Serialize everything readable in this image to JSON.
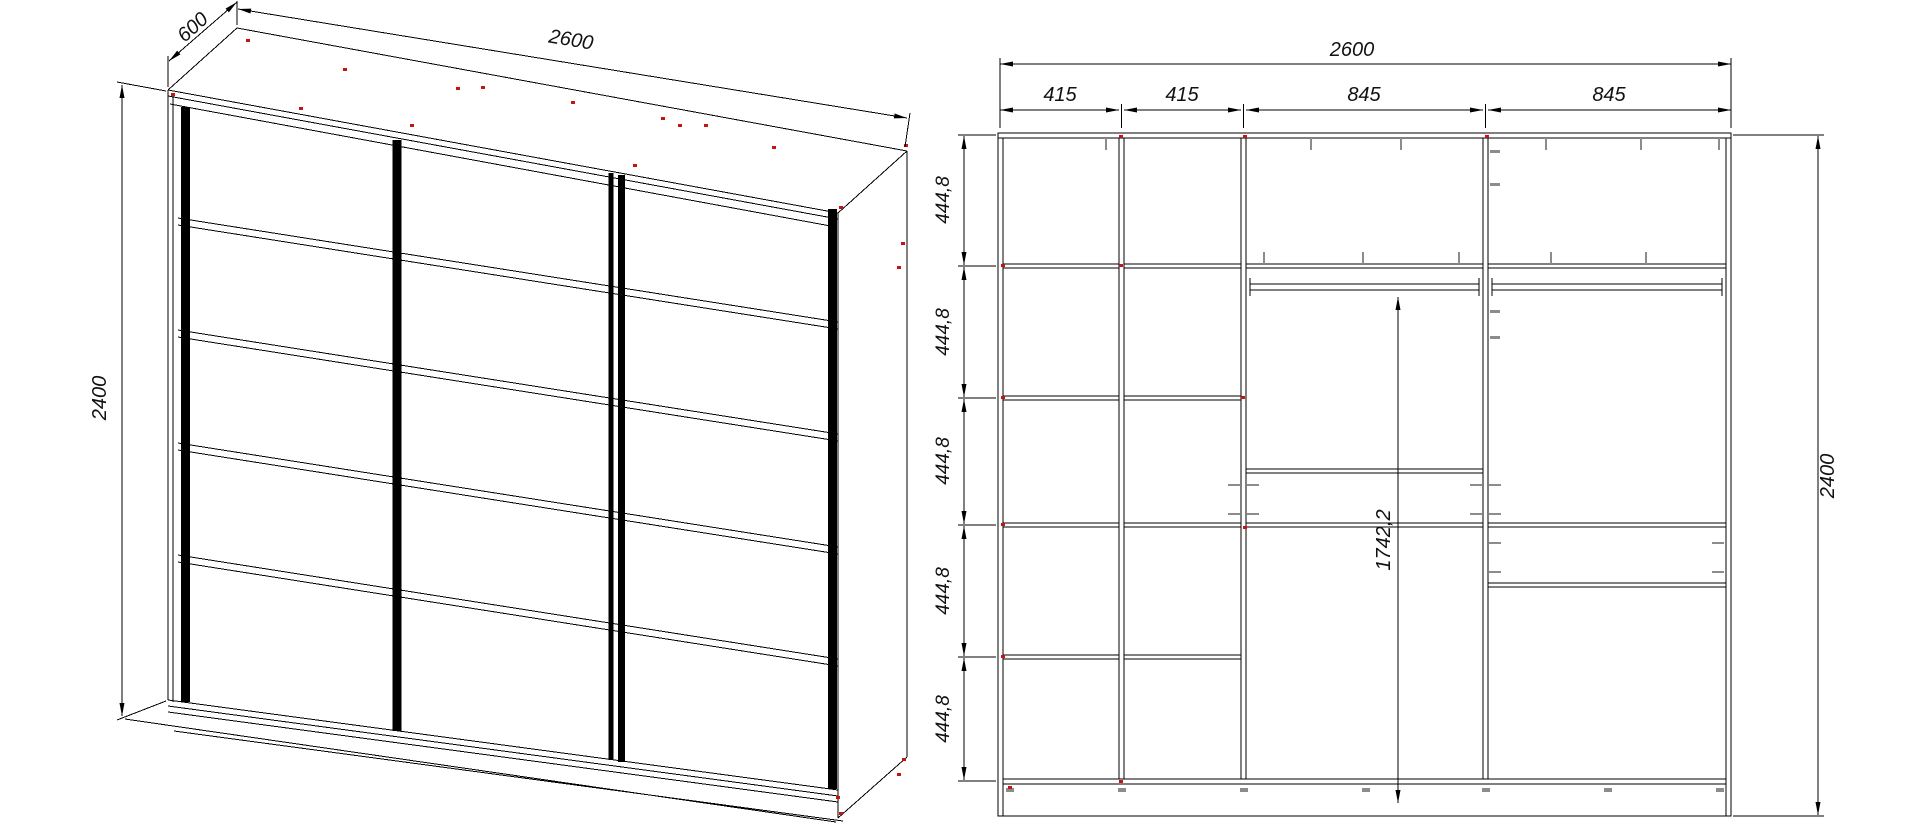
{
  "left_view": {
    "width_label": "2600",
    "depth_label": "600",
    "height_label": "2400"
  },
  "right_view": {
    "total_width_label": "2600",
    "column_labels": [
      "415",
      "415",
      "845",
      "845"
    ],
    "row_labels": [
      "444,8",
      "444,8",
      "444,8",
      "444,8",
      "444,8"
    ],
    "height_label": "2400",
    "hanging_height_label": "1742,2"
  },
  "colors": {
    "line": "#000000",
    "hardware": "#8c8c8c",
    "drill_mark": "#c41414",
    "background": "#ffffff"
  }
}
